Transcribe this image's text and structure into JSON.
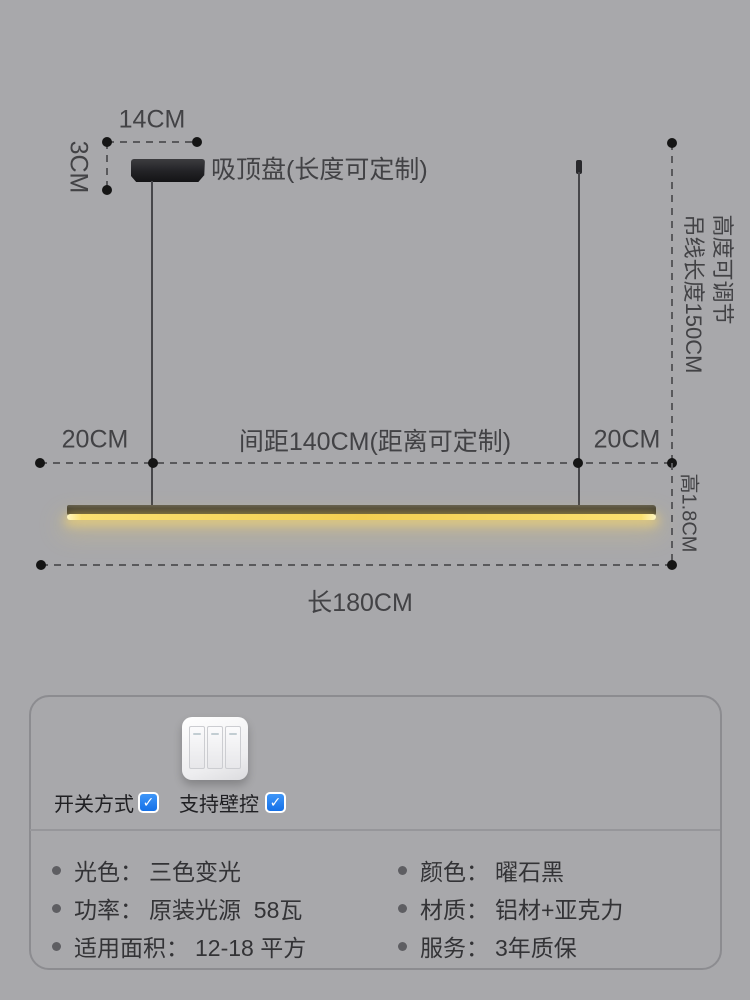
{
  "diagram": {
    "canopy_width": "14CM",
    "canopy_height": "3CM",
    "canopy_label": "吸顶盘(长度可定制)",
    "suspension_line1": "高度可调节",
    "suspension_line2": "吊线长度150CM",
    "overhang_left": "20CM",
    "spacing_label": "间距140CM(距离可定制)",
    "overhang_right": "20CM",
    "bar_height": "高1.8CM",
    "bar_length": "长180CM"
  },
  "card": {
    "switch": {
      "method_label": "开关方式",
      "wall_label": "支持壁控",
      "checkmark": "✓",
      "checked": true
    },
    "specs_left": [
      {
        "label": "光色：",
        "value": "三色变光"
      },
      {
        "label": "功率：",
        "value": "原装光源  58瓦"
      },
      {
        "label": "适用面积：",
        "value": "12-18 平方"
      }
    ],
    "specs_right": [
      {
        "label": "颜色：",
        "value": "曜石黑"
      },
      {
        "label": "材质：",
        "value": "铝材+亚克力"
      },
      {
        "label": "服务：",
        "value": "3年质保"
      }
    ]
  },
  "colors": {
    "background": "#a8a8ab",
    "dimension_text": "#424245",
    "dimension_dot": "#151515",
    "lamp_body": "#35322a",
    "lamp_glow": "#f3cf52",
    "checkbox_blue": "#1e7df2",
    "card_border": "#8c8c90"
  }
}
